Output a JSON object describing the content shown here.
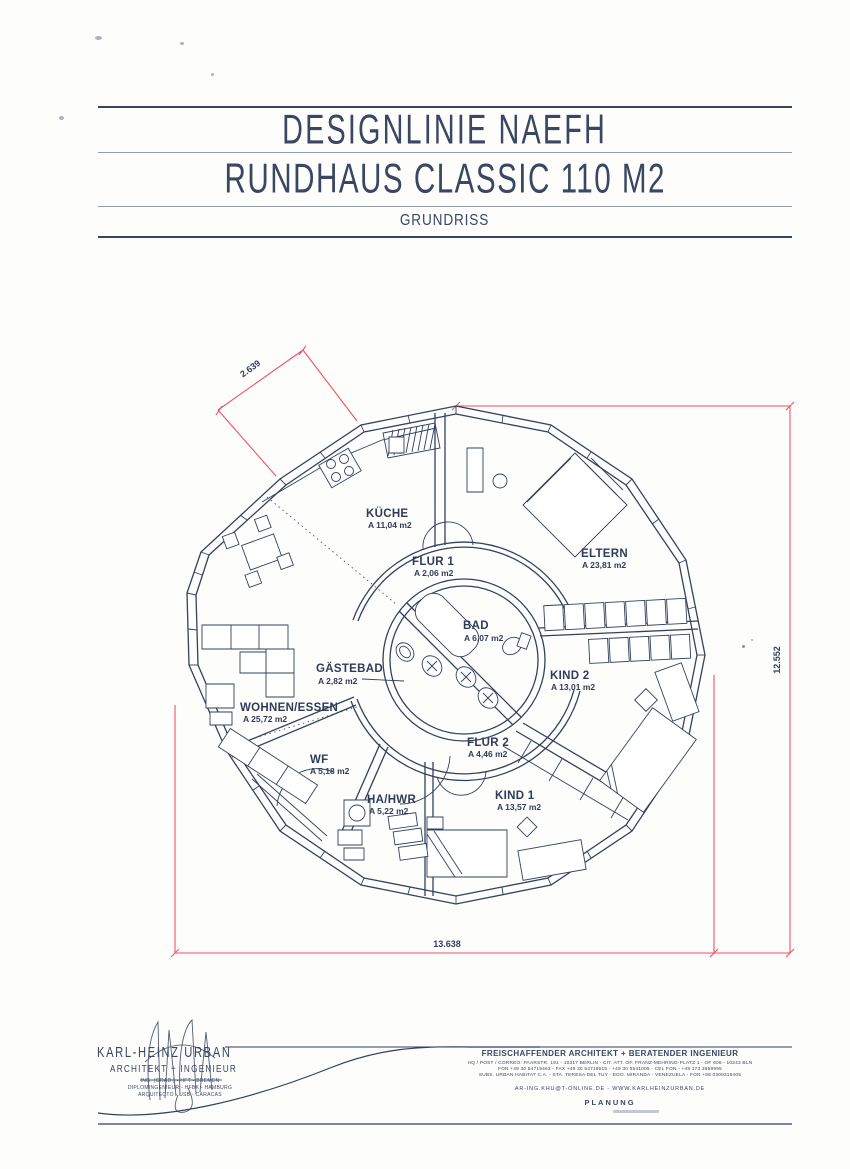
{
  "header": {
    "line1": "DESIGNLINIE NAEFH",
    "line2": "RUNDHAUS CLASSIC 110 M2",
    "line3": "GRUNDRISS"
  },
  "plan": {
    "rooms": [
      {
        "name": "KÜCHE",
        "area": "A 11,04 m2"
      },
      {
        "name": "FLUR 1",
        "area": "A 2,06 m2"
      },
      {
        "name": "ELTERN",
        "area": "A 23,81 m2"
      },
      {
        "name": "BAD",
        "area": "A 6,07 m2"
      },
      {
        "name": "GÄSTEBAD",
        "area": "A 2,82 m2"
      },
      {
        "name": "KIND 2",
        "area": "A 13,01 m2"
      },
      {
        "name": "WOHNEN/ESSEN",
        "area": "A 25,72 m2"
      },
      {
        "name": "WF",
        "area": "A 5,18 m2"
      },
      {
        "name": "FLUR 2",
        "area": "A 4,46 m2"
      },
      {
        "name": "HA/HWR",
        "area": "A 5,22 m2"
      },
      {
        "name": "KIND 1",
        "area": "A 13,57 m2"
      }
    ],
    "dimensions": {
      "facade_segment": "2.639",
      "overall_height": "12.552",
      "overall_width": "13.638"
    }
  },
  "footer": {
    "logo_name": "KARL-HEINZ URBAN",
    "logo_title": "ARCHITEKT + INGENIEUR",
    "logo_lines": [
      "ING. (GRAD.) - HFT - BREMEN",
      "DIPLOMINGENIEUR - HFBK - HAMBURG",
      "ARQUITECTO - USB - CARACAS"
    ],
    "office_title": "FREISCHAFFENDER ARCHITEKT + BERATENDER INGENIEUR",
    "office_lines": [
      "HQ / POST / CORREO: PAARSTR. 191 - 10317 BERLIN - CIT. ATT. OF. FRANZ-MEHRING-PLATZ 1 - OF 606 - 10243 BLN",
      "FON +49 30 54719463 - FAX +49 30 54719515 - +49 30 5541005 - CEL FON - +49 173 3659995",
      "SUBS. URBAN HABITAT C.A. - STA. TERESA DEL TUY - EDO. MIRANDA - VENEZUELA - FON +58 0309315405"
    ],
    "web_line": "AR-ING.KHU@T-ONLINE.DE  -  WWW.KARLHEINZURBAN.DE",
    "stage": "PLANUNG"
  },
  "colors": {
    "ink": "#2f3b58",
    "dimension_red": "#f0506a",
    "paper": "#fdfdfc"
  }
}
